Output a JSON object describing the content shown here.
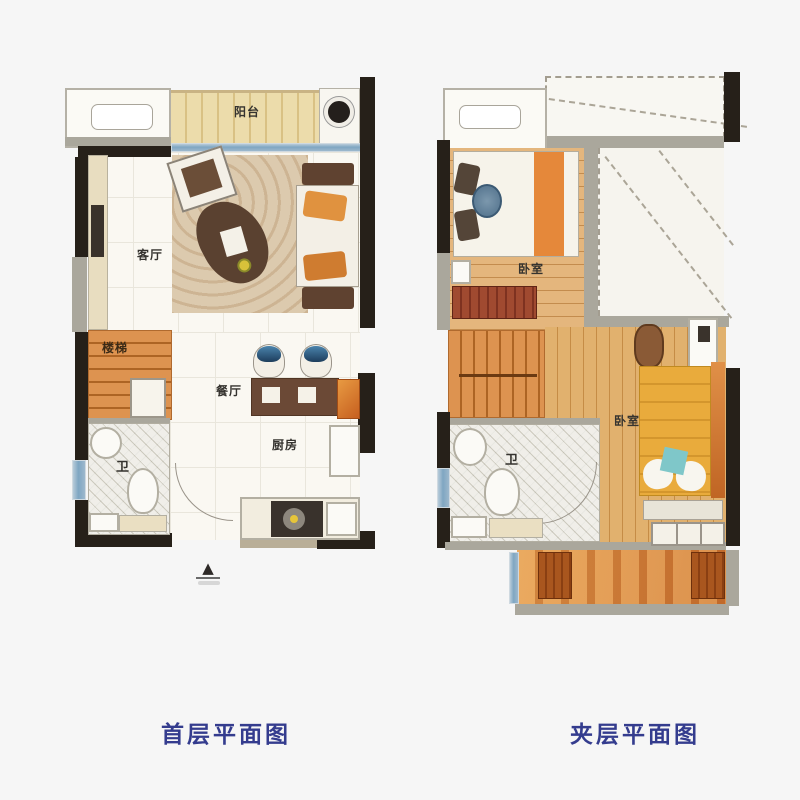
{
  "plans": {
    "first_floor": {
      "caption": "首层平面图",
      "labels": {
        "balcony": "阳台",
        "living_room": "客厅",
        "stairs": "楼梯",
        "bathroom": "卫",
        "dining_room": "餐厅",
        "kitchen": "厨房"
      },
      "entrance_marker": "▲"
    },
    "mezzanine": {
      "caption": "夹层平面图",
      "labels": {
        "bedroom_1": "卧室",
        "bathroom": "卫",
        "bedroom_2": "卧室"
      }
    }
  },
  "colors": {
    "wall_dark": "#262019",
    "wall_gray": "#aaa79c",
    "wood_floor": "#d9a258",
    "stairs_orange": "#dd9350",
    "balcony_beige": "#ecdcab",
    "window_blue": "#7fa6c2",
    "carpet_beige": "#dccaae",
    "tile_gray": "#e0ded3",
    "table_brown": "#6b4936",
    "bed_blanket_orange": "#e5883a",
    "bed_yellow": "#e9ab3c",
    "dresser_red": "#9c4630",
    "caption_navy": "#343c8e"
  }
}
